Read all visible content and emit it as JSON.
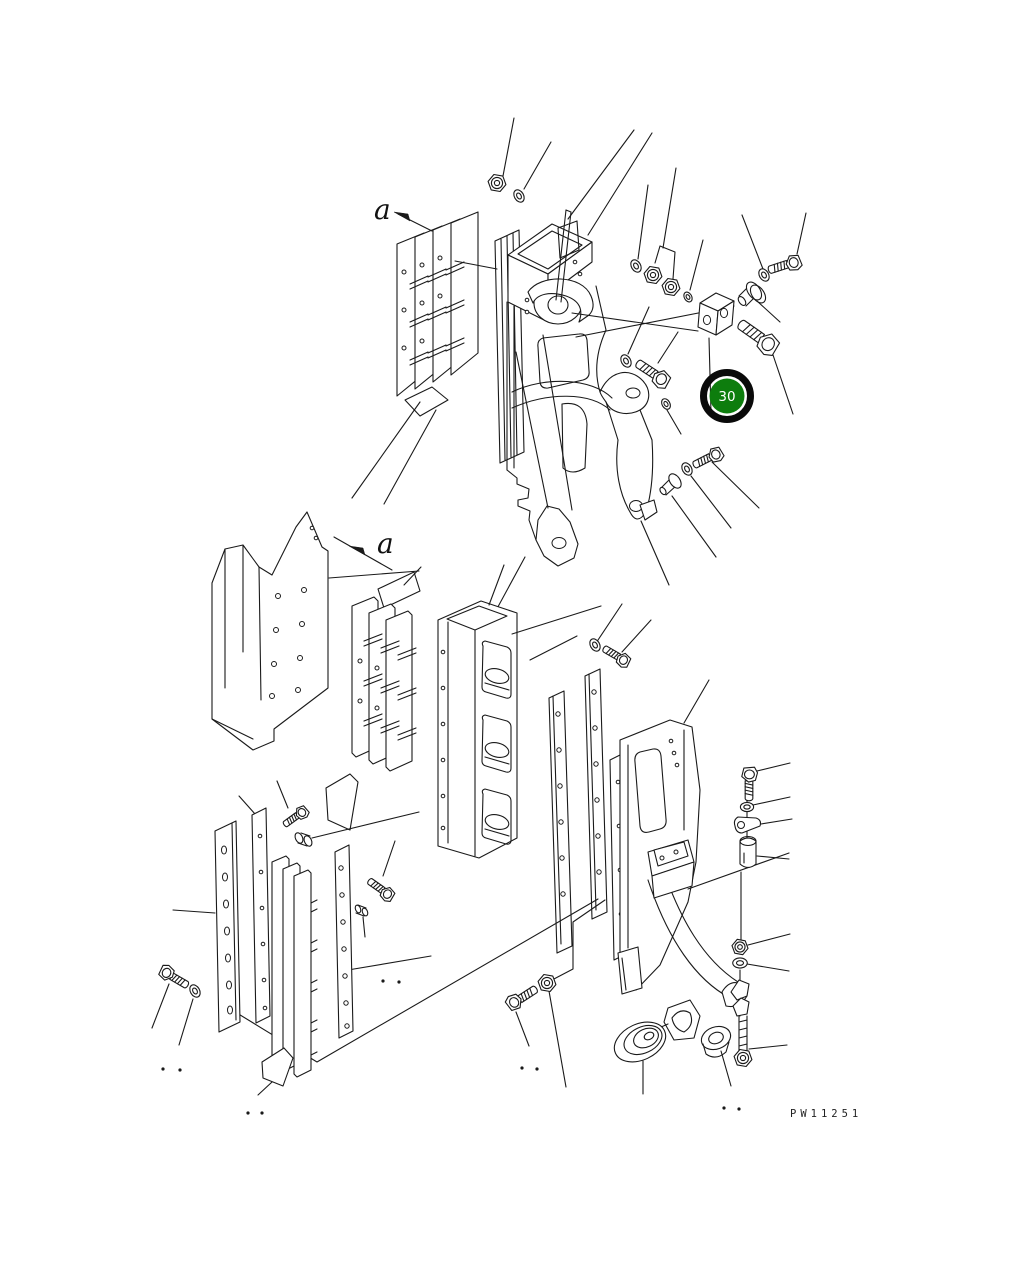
{
  "figure": {
    "type": "exploded-parts-diagram",
    "drawing_number": "PW11251",
    "view_labels": {
      "upper": "a",
      "lower": "a"
    },
    "callout": {
      "number": "30",
      "fill_color": "#0d7d0d",
      "ring_color": "#0a0a0a",
      "text_color": "#ffffff"
    },
    "colors": {
      "background": "#ffffff",
      "line": "#1a1a1a"
    },
    "parts_visible": [
      "slotted-plate-stack",
      "mounting-bracket",
      "hex-bolt",
      "flat-washer",
      "hex-nut",
      "clevis-block",
      "flanged-pin",
      "corner-plate",
      "channel-frame",
      "side-strip",
      "main-frame",
      "link-plate",
      "bushing",
      "clamp-saddle",
      "stud-with-nut",
      "grommet",
      "plug"
    ]
  }
}
